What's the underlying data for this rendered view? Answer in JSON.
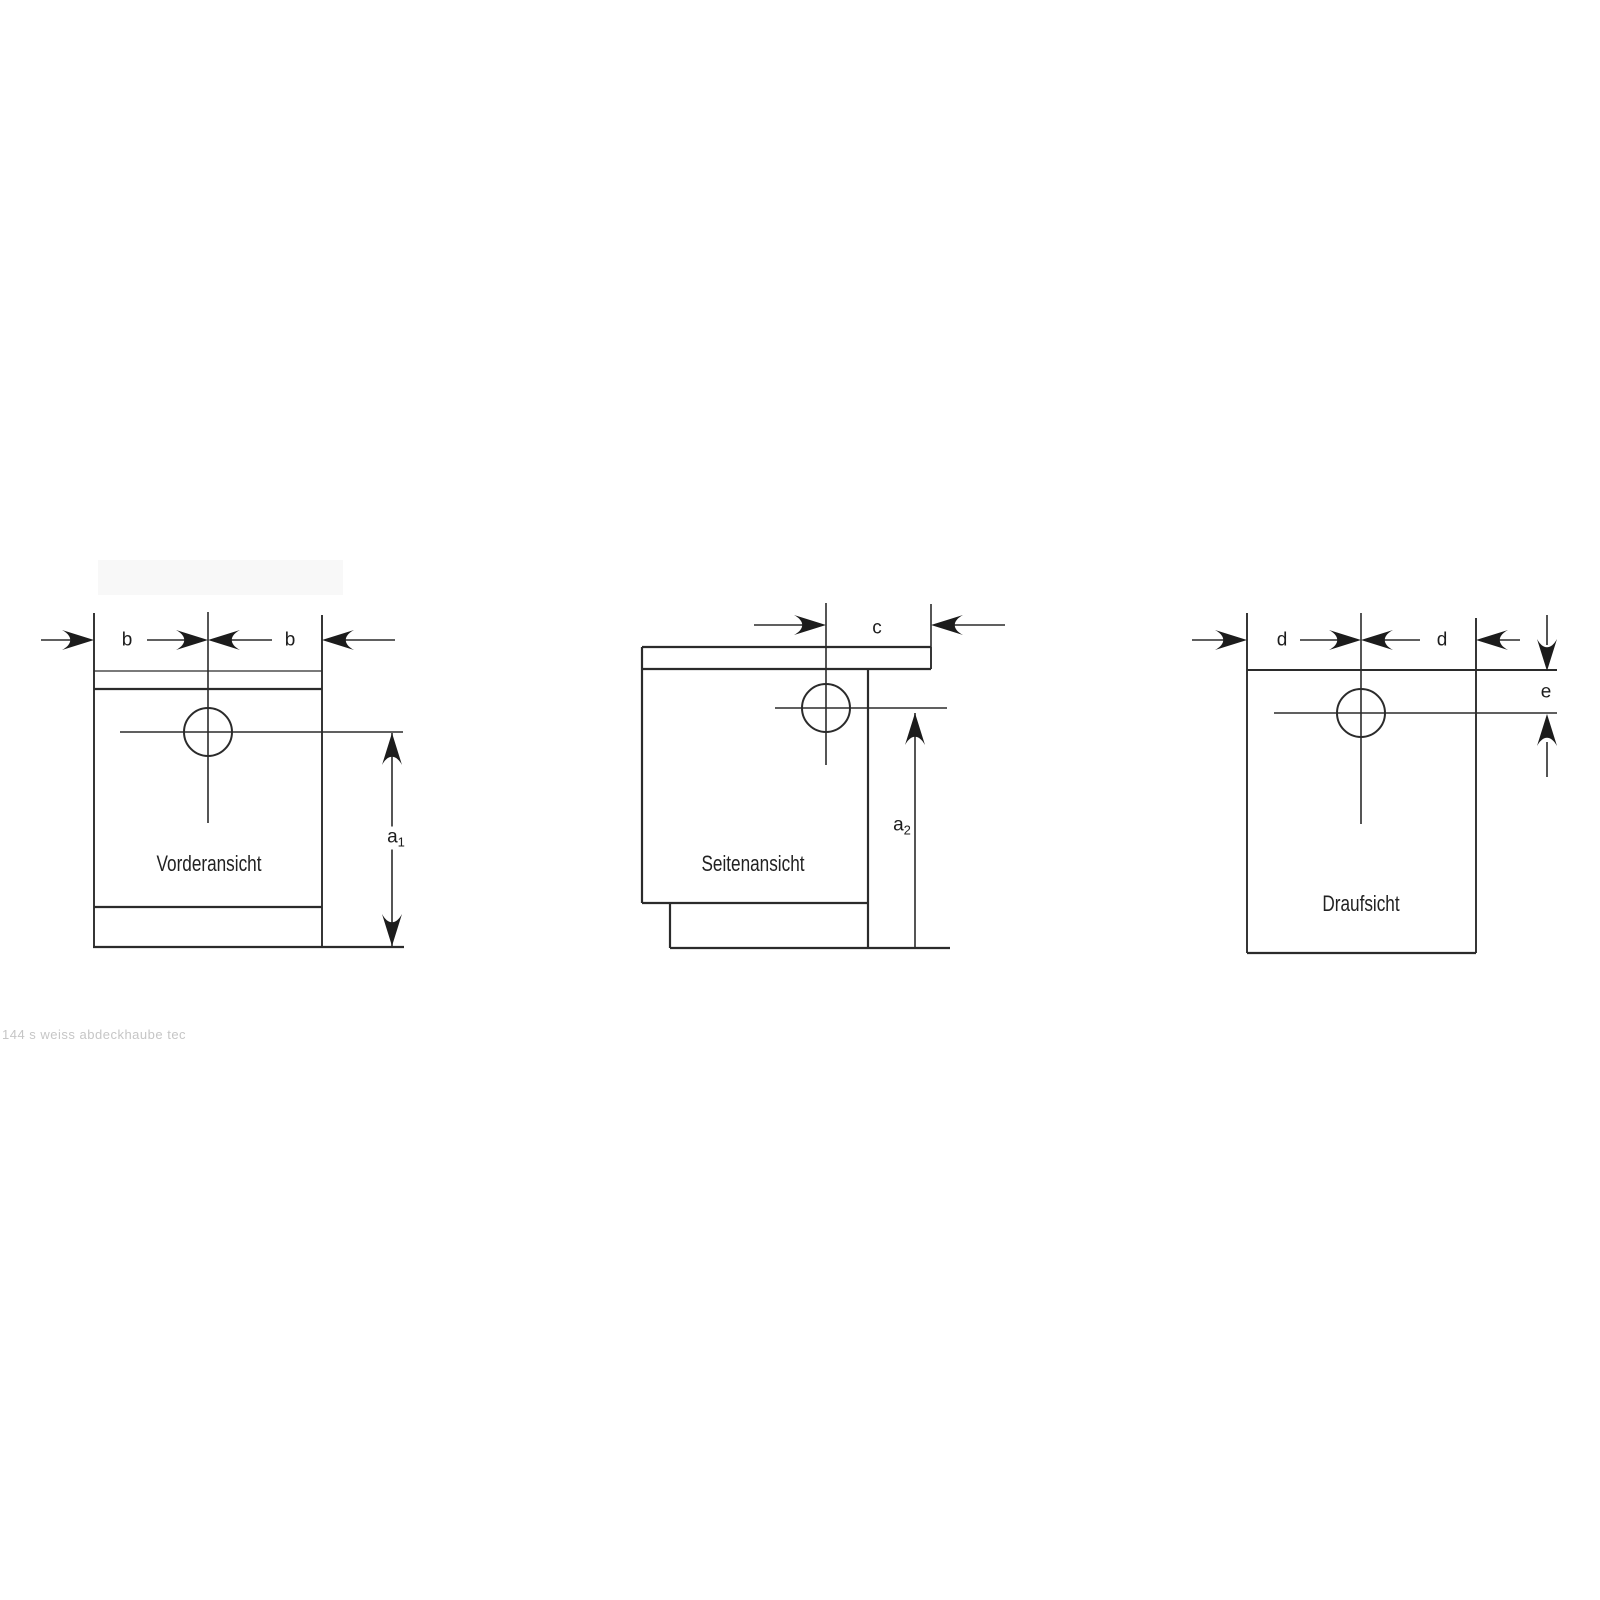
{
  "drawing": {
    "description_labels": {
      "front_view_title": "Vorderansicht",
      "side_view_title": "Seitenansicht",
      "top_view_title": "Draufsicht"
    },
    "dimensions": {
      "front": {
        "b_left": "b",
        "b_right": "b",
        "a1_base": "a",
        "a1_sub": "1"
      },
      "side": {
        "c": "c",
        "a2_base": "a",
        "a2_sub": "2"
      },
      "top": {
        "d_left": "d",
        "d_right": "d",
        "e": "e"
      }
    },
    "watermark_text": "144 s weiss abdeckhaube tec",
    "colors": {
      "line": "#2b2b2b",
      "arrow_fill": "#1c1c1c",
      "text": "#1d1d1d",
      "watermark": "#c6c6c6",
      "background": "#ffffff",
      "erased_block": "#f8f8f8"
    }
  }
}
